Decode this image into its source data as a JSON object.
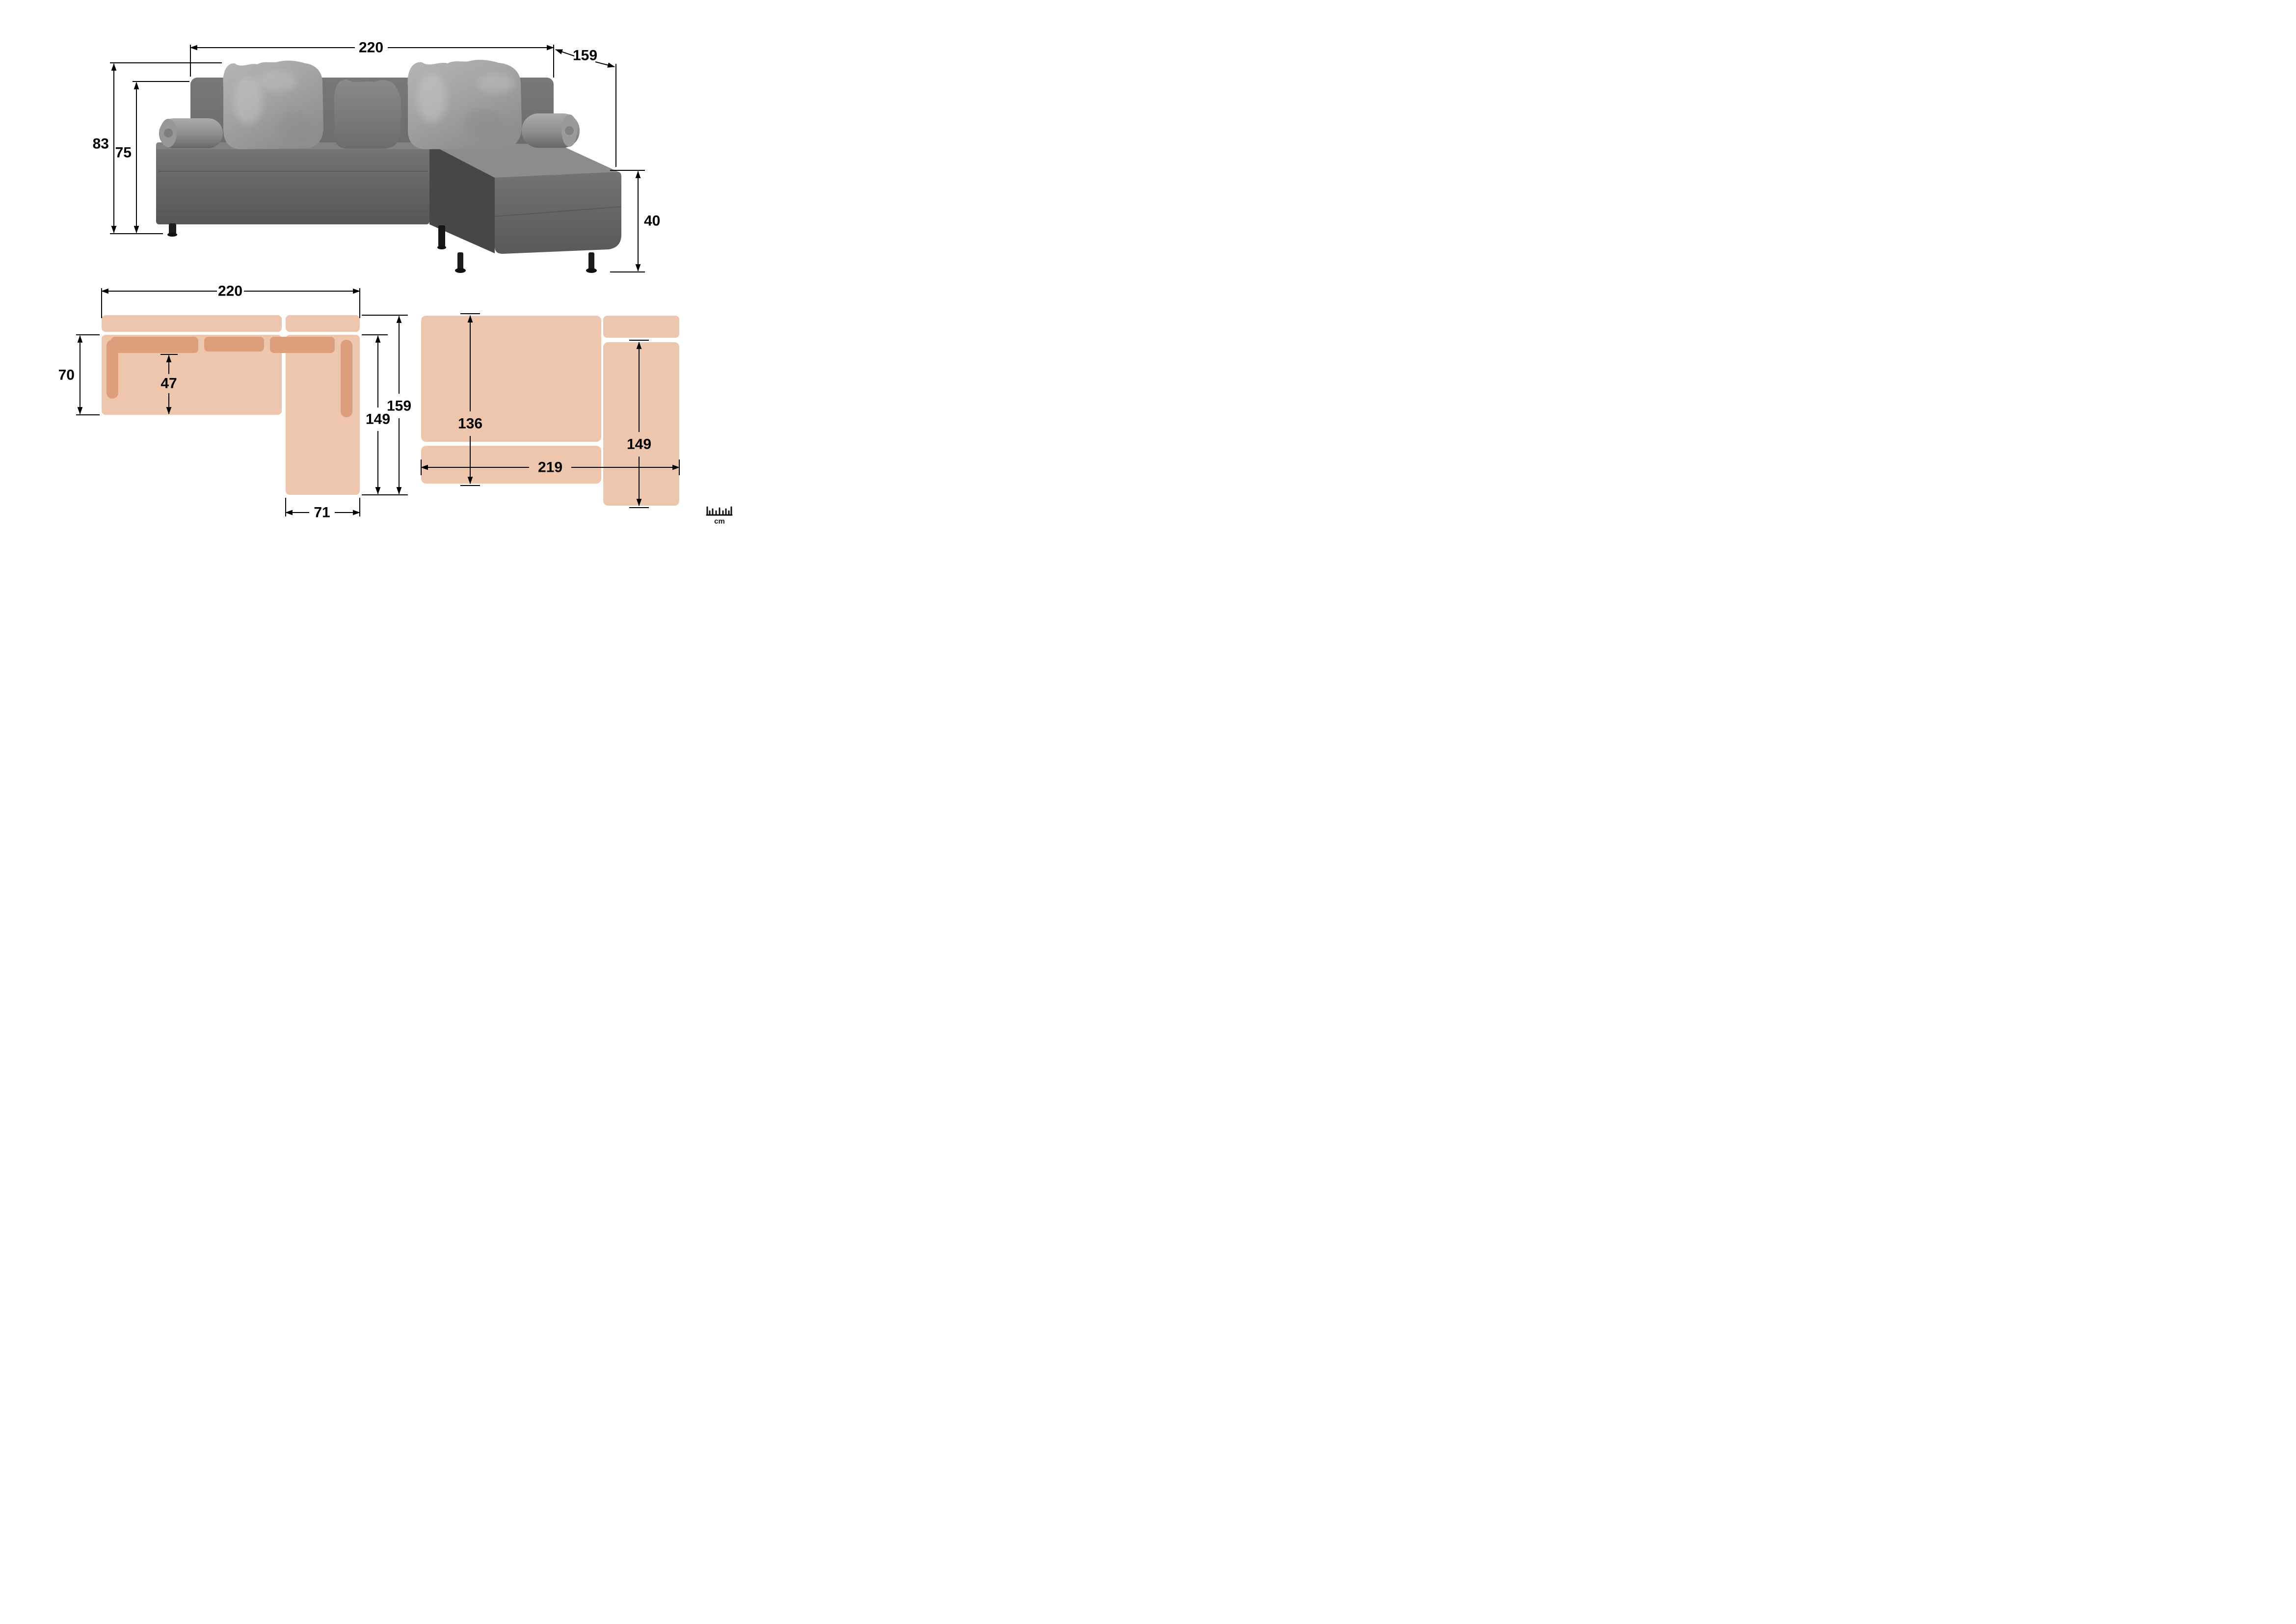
{
  "front_view": {
    "description": "corner sofa front photo with overall dimensions in cm",
    "dimensions": {
      "width_cm": "220",
      "chaise_depth_cm": "159",
      "total_height_cm": "83",
      "backrest_height_cm": "75",
      "chaise_seat_height_cm": "40"
    }
  },
  "top_view_sofa": {
    "description": "top view schematic of sofa configuration",
    "dimensions": {
      "total_width_cm": "220",
      "seat_depth_cm": "70",
      "cushion_to_front_cm": "47",
      "chaise_length_cm": "149",
      "total_depth_cm": "159",
      "chaise_width_cm": "71"
    }
  },
  "top_view_bed": {
    "description": "top view schematic of fold-out bed configuration",
    "dimensions": {
      "mattress_width_cm": "136",
      "right_section_length_cm": "149",
      "bed_length_cm": "219"
    }
  },
  "ruler": {
    "unit_label": "cm"
  },
  "colors": {
    "peach_light": "#eec6ae",
    "peach_dark": "#dd9f7b",
    "dimension_line": "#000000",
    "sofa_body_gray": "#6b6b6b",
    "sofa_chaise_top_gray": "#8c8c8c",
    "pillow_light_gray": "#a6a6a6",
    "pillow_mid_gray": "#7d7d7d",
    "leg_black": "#1c1c1c",
    "background": "#ffffff"
  }
}
